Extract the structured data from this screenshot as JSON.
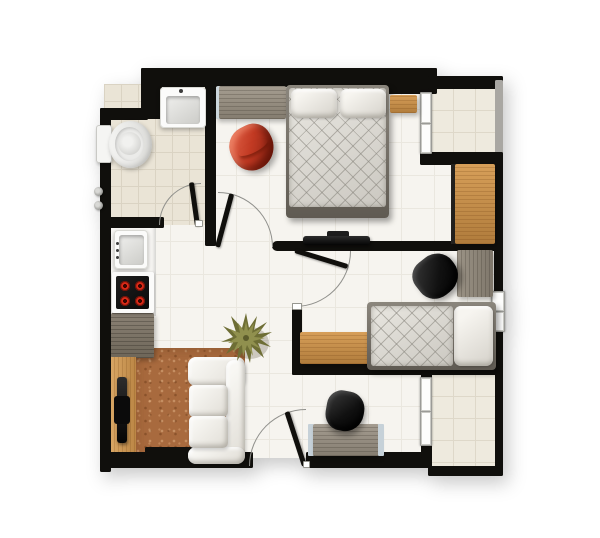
{
  "meta": {
    "type": "apartment-floor-plan",
    "view": "top-down",
    "rooms": [
      "bathroom",
      "kitchen",
      "living-room",
      "hallway",
      "master-bedroom",
      "second-bedroom",
      "north-balcony",
      "south-terrace",
      "work-nook"
    ],
    "canvas": {
      "width": 600,
      "height": 538
    }
  },
  "palette": {
    "wall": "#100f0c",
    "floor": "#f6f4ef",
    "floorline": "#eae7df",
    "bath": "#eae4d6",
    "bathline": "#dad3c3",
    "balcony": "#eeeade",
    "balconyline": "#ded8c9",
    "cork": "#a86a3e",
    "arcline": "#90908c"
  },
  "elements": {
    "floor-base": {
      "rect": [
        110,
        84,
        384,
        374
      ]
    },
    "floor-bathroom": {
      "rect": [
        104,
        84,
        104,
        141
      ]
    },
    "floor-balcony-north": {
      "rect": [
        431,
        88,
        65,
        66
      ]
    },
    "floor-terrace-south": {
      "rect": [
        431,
        374,
        65,
        93
      ]
    },
    "floor-cork-living": {
      "rect": [
        135,
        348,
        110,
        114
      ]
    },
    "kitchen-counter": {
      "rect": [
        110,
        224,
        46,
        92
      ],
      "fill": "#f8f7f4"
    },
    "kitchen-counter-low": {
      "rect": [
        111,
        313,
        43,
        45
      ]
    },
    "tv-cabinet-living": {
      "rect": [
        110,
        357,
        26,
        106
      ]
    },
    "wall-left": {
      "rect": [
        100,
        108,
        11,
        364
      ]
    },
    "wall-bath-step": {
      "rect": [
        100,
        108,
        48,
        12
      ]
    },
    "wall-top-chunk": {
      "rect": [
        141,
        68,
        21,
        51
      ]
    },
    "wall-top": {
      "rect": [
        141,
        68,
        296,
        19
      ]
    },
    "wall-ne-pillar": {
      "rect": [
        385,
        68,
        52,
        26
      ]
    },
    "wall-master-east": {
      "rect": [
        420,
        68,
        12,
        90
      ]
    },
    "wall-balcony-top": {
      "rect": [
        428,
        76,
        75,
        13
      ]
    },
    "wall-balcony-east": {
      "rect": [
        495,
        80,
        8,
        76
      ]
    },
    "wall-balcony-bottom": {
      "rect": [
        420,
        152,
        83,
        13
      ]
    },
    "wall-east": {
      "rect": [
        494,
        158,
        9,
        217
      ]
    },
    "wall-bedroom-divider": {
      "rect": [
        272,
        241,
        231,
        10
      ]
    },
    "wall-bedroom2-stub": {
      "rect": [
        292,
        303,
        10,
        72
      ]
    },
    "wall-bedroom2-bottom": {
      "rect": [
        292,
        364,
        211,
        11
      ]
    },
    "wall-bath-bottom": {
      "rect": [
        100,
        217,
        64,
        11
      ]
    },
    "wall-bath-east": {
      "rect": [
        205,
        84,
        11,
        162
      ]
    },
    "wall-bottom-west": {
      "rect": [
        100,
        452,
        153,
        16
      ]
    },
    "wall-bottom-chunk": {
      "rect": [
        145,
        447,
        48,
        21
      ]
    },
    "wall-bottom-east": {
      "rect": [
        306,
        452,
        126,
        16
      ]
    },
    "wall-terrace-stub-top": {
      "rect": [
        421,
        364,
        11,
        15
      ]
    },
    "wall-terrace-stub-bottom": {
      "rect": [
        421,
        445,
        11,
        13
      ]
    },
    "wall-terrace-east": {
      "rect": [
        495,
        366,
        8,
        109
      ]
    },
    "wall-terrace-bottom": {
      "rect": [
        428,
        466,
        75,
        10
      ]
    },
    "window-master-balcony": {
      "rect": [
        420,
        92,
        12,
        62
      ]
    },
    "window-bedroom2-east": {
      "rect": [
        491,
        291,
        14,
        41
      ]
    },
    "window-terrace-divider": {
      "rect": [
        420,
        377,
        12,
        69
      ]
    },
    "dresser-master": {
      "rect": [
        216,
        86,
        70,
        33
      ]
    },
    "bed-master-frame": {
      "rect": [
        286,
        85,
        103,
        133
      ]
    },
    "bed-master-mattress": {
      "rect": [
        289,
        88,
        97,
        119
      ]
    },
    "bed-master-pillow-left": {
      "rect": [
        291,
        89,
        46,
        29
      ]
    },
    "bed-master-pillow-right": {
      "rect": [
        340,
        89,
        46,
        29
      ]
    },
    "nightstand-master": {
      "rect": [
        390,
        95,
        27,
        18
      ]
    },
    "wardrobe-edge": {
      "rect": [
        451,
        164,
        5,
        80
      ],
      "fill": "#23211e"
    },
    "wardrobe-master": {
      "rect": [
        455,
        164,
        40,
        80
      ]
    },
    "tv-master-stand": {
      "rect": [
        327,
        231,
        22,
        7
      ],
      "fill": "#1d1d1d"
    },
    "tv-master": {
      "rect": [
        303,
        236,
        67,
        9
      ]
    },
    "dresser-bedroom2": {
      "rect": [
        457,
        250,
        36,
        47
      ]
    },
    "cabinet-bedroom2": {
      "rect": [
        300,
        332,
        70,
        32
      ]
    },
    "bed-single-frame": {
      "rect": [
        367,
        302,
        129,
        68
      ]
    },
    "bed-single-mattress": {
      "rect": [
        371,
        306,
        82,
        60
      ]
    },
    "bed-single-pillow": {
      "rect": [
        454,
        306,
        39,
        60
      ]
    },
    "desk-south-trim-left": {
      "rect": [
        308,
        424,
        6,
        32
      ]
    },
    "desk-south": {
      "rect": [
        313,
        424,
        66,
        32
      ]
    },
    "desk-south-trim-right": {
      "rect": [
        378,
        424,
        6,
        32
      ]
    },
    "kitchen-sink-body": {
      "rect": [
        114,
        230,
        34,
        39
      ]
    },
    "kitchen-sink-basin": {
      "rect": [
        119,
        235,
        25,
        30
      ]
    },
    "kitchen-faucet-dot-1": {
      "rect": [
        116,
        242,
        3,
        3
      ]
    },
    "kitchen-faucet-dot-2": {
      "rect": [
        116,
        249,
        3,
        3
      ]
    },
    "kitchen-faucet-dot-3": {
      "rect": [
        116,
        256,
        3,
        3
      ]
    },
    "stove-surround": {
      "rect": [
        112,
        272,
        42,
        41
      ]
    },
    "stove-panel": {
      "rect": [
        116,
        276,
        33,
        33
      ]
    },
    "burner-1": {
      "rect": [
        119,
        280,
        12,
        12
      ]
    },
    "burner-2": {
      "rect": [
        134,
        280,
        12,
        12
      ]
    },
    "burner-3": {
      "rect": [
        119,
        295,
        12,
        12
      ]
    },
    "burner-4": {
      "rect": [
        134,
        295,
        12,
        12
      ]
    },
    "tv-living": {
      "rect": [
        117,
        377,
        10,
        66
      ]
    },
    "tv-living-center": {
      "rect": [
        114,
        396,
        16,
        28
      ],
      "fill": "#0b0b0b"
    },
    "sofa-armrest-top": {
      "rect": [
        188,
        357,
        57,
        29
      ]
    },
    "sofa-backrest": {
      "rect": [
        226,
        360,
        19,
        100
      ]
    },
    "sofa-armrest-bottom": {
      "rect": [
        188,
        447,
        57,
        17
      ]
    },
    "sofa-cushion-1": {
      "rect": [
        189,
        385,
        39,
        32
      ]
    },
    "sofa-cushion-2": {
      "rect": [
        189,
        416,
        39,
        32
      ]
    },
    "bath-sink-body": {
      "rect": [
        160,
        87,
        46,
        41
      ]
    },
    "bath-sink-basin": {
      "rect": [
        166,
        96,
        34,
        28
      ]
    },
    "bath-faucet-dot": {
      "rect": [
        179,
        89,
        4,
        4
      ]
    },
    "toilet-tank": {
      "rect": [
        96,
        125,
        16,
        38
      ]
    },
    "toilet-bowl": {
      "rect": [
        109,
        121,
        43,
        47
      ]
    },
    "toilet-inner": {
      "rect": [
        115,
        127,
        29,
        34
      ]
    },
    "toilet-seat-circle": {
      "rect": [
        118,
        132,
        23,
        23
      ]
    },
    "shower-knob-top": {
      "rect": [
        94,
        187,
        9,
        9
      ]
    },
    "shower-knob-bottom": {
      "rect": [
        94,
        201,
        9,
        9
      ]
    },
    "door-bath-arc": {
      "rect": [
        159,
        183,
        42,
        42
      ]
    },
    "door-bath-leaf": {
      "rect": [
        195,
        182,
        5,
        44
      ],
      "rotate": -8,
      "origin": "50% 100%"
    },
    "door-bath-jamb": {
      "rect": [
        195,
        220,
        8,
        7
      ]
    },
    "door-master-arc": {
      "rect": [
        218,
        192,
        55,
        55
      ]
    },
    "door-master-leaf": {
      "rect": [
        215,
        192,
        5,
        55
      ],
      "rotate": 15,
      "origin": "50% 100%"
    },
    "door-bedroom2-arc": {
      "rect": [
        295,
        251,
        56,
        56
      ]
    },
    "door-bedroom2-leaf": {
      "rect": [
        295,
        248,
        55,
        5
      ],
      "rotate": 17,
      "origin": "0% 50%"
    },
    "door-bedroom2-jamb": {
      "rect": [
        292,
        303,
        10,
        7
      ]
    },
    "door-entry-arc": {
      "rect": [
        249,
        409,
        57,
        57
      ]
    },
    "door-entry-leaf": {
      "rect": [
        302,
        409,
        5,
        57
      ],
      "rotate": -18,
      "origin": "50% 100%"
    },
    "door-entry-jamb": {
      "rect": [
        303,
        461,
        7,
        7
      ]
    },
    "chair-bedroom2": {
      "rect": [
        414,
        255,
        44,
        42
      ],
      "rotate": -38
    },
    "chair-desk-south": {
      "rect": [
        326,
        391,
        38,
        40
      ],
      "rotate": 10
    },
    "chair-red-master": {
      "rect": [
        230,
        125,
        44,
        45
      ],
      "rotate": -27
    },
    "plant-living": {
      "rect": [
        219,
        311,
        54,
        54
      ]
    }
  }
}
